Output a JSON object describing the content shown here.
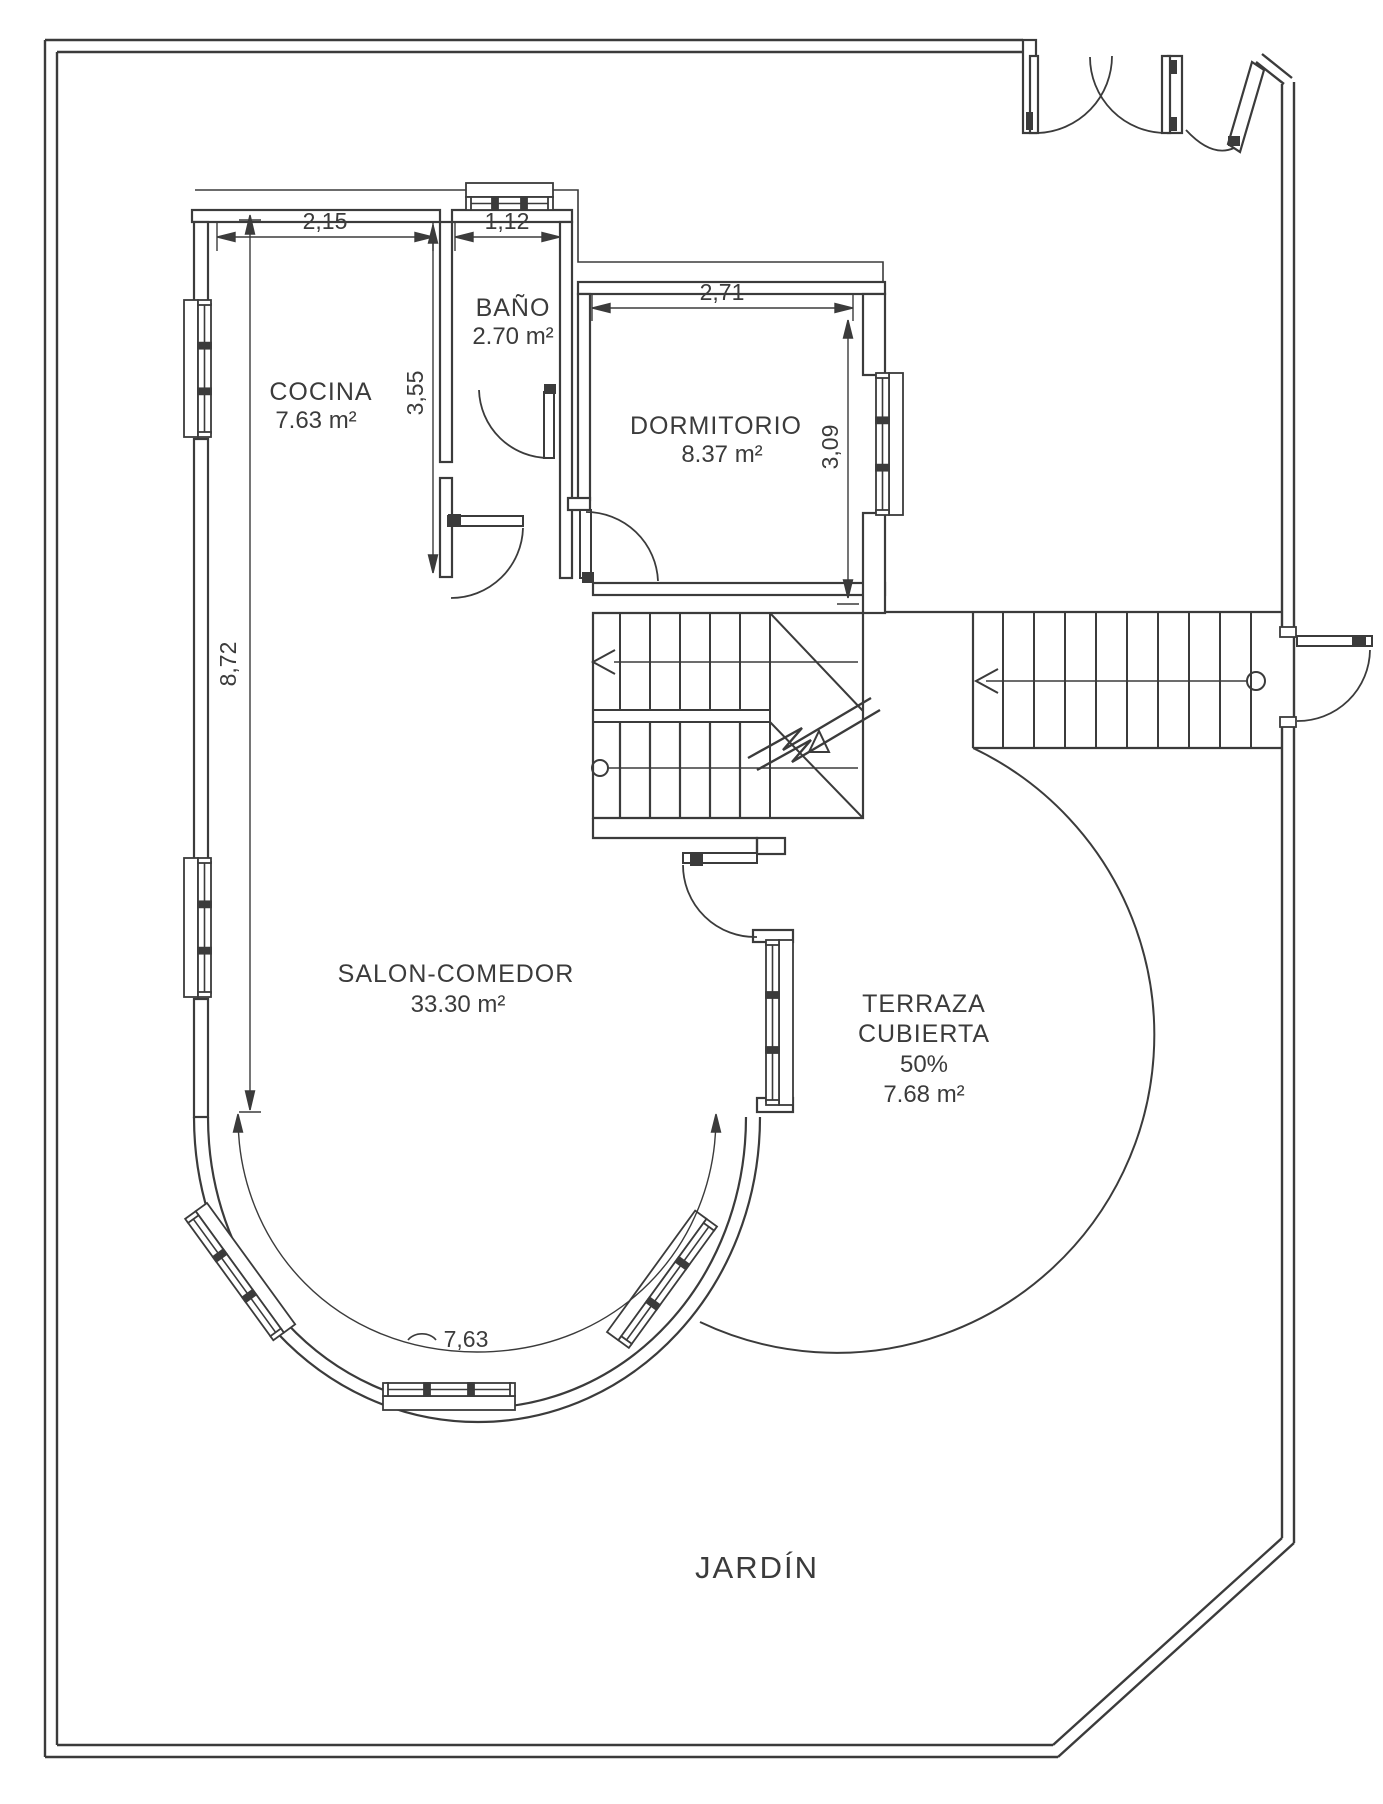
{
  "plan": {
    "rooms": {
      "cocina": {
        "name": "COCINA",
        "area": "7.63 m²"
      },
      "bano": {
        "name": "BAÑO",
        "area": "2.70 m²"
      },
      "dormitorio": {
        "name": "DORMITORIO",
        "area": "8.37 m²"
      },
      "salon": {
        "name": "SALON-COMEDOR",
        "area": "33.30 m²"
      },
      "terraza": {
        "line1": "TERRAZA",
        "line2": "CUBIERTA",
        "line3": "50%",
        "line4": "7.68 m²"
      },
      "jardin": {
        "name": "JARDÍN"
      }
    },
    "dimensions": {
      "cocina_width": "2,15",
      "bano_width": "1,12",
      "dormitorio_width": "2,71",
      "cocina_depth": "3,55",
      "dormitorio_depth": "3,09",
      "salon_depth": "8,72",
      "bay_arc_length": "7,63"
    },
    "colors": {
      "line": "#3b3b3b",
      "background": "#ffffff"
    }
  }
}
